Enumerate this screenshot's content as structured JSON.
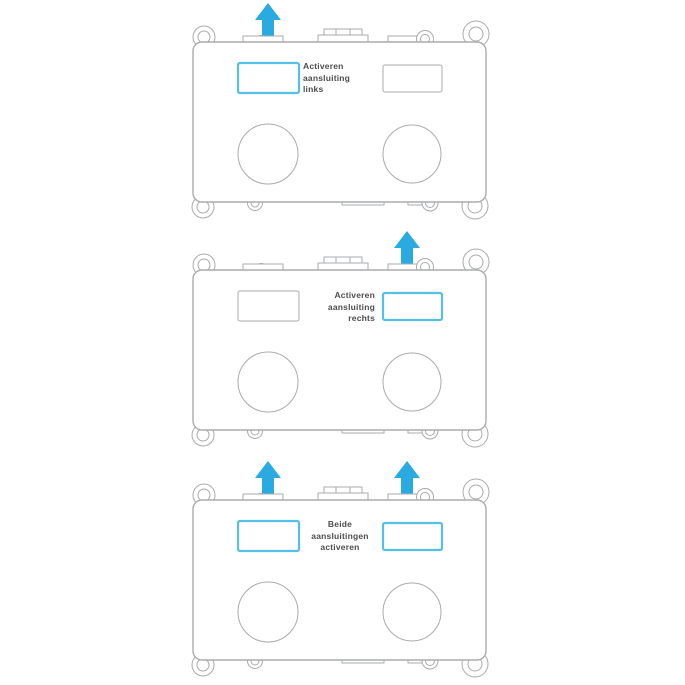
{
  "colors": {
    "page_background": "#ffffff",
    "accent_arrow": "#29abe2",
    "highlight_border": "#54c0e8",
    "outline_gray": "#a9abad",
    "label_text": "#4d4d4f"
  },
  "diagrams": [
    {
      "id": "activate-left",
      "label": {
        "lines": [
          "Activeren",
          "aansluiting",
          "links"
        ],
        "align": "left"
      },
      "arrows": {
        "left": true,
        "right": false
      },
      "highlight": {
        "left": true,
        "right": false
      }
    },
    {
      "id": "activate-right",
      "label": {
        "lines": [
          "Activeren",
          "aansluiting",
          "rechts"
        ],
        "align": "right"
      },
      "arrows": {
        "left": false,
        "right": true
      },
      "highlight": {
        "left": false,
        "right": true
      }
    },
    {
      "id": "activate-both",
      "label": {
        "lines": [
          "Beide",
          "aansluitingen",
          "activeren"
        ],
        "align": "center"
      },
      "arrows": {
        "left": true,
        "right": true
      },
      "highlight": {
        "left": true,
        "right": true
      }
    }
  ]
}
